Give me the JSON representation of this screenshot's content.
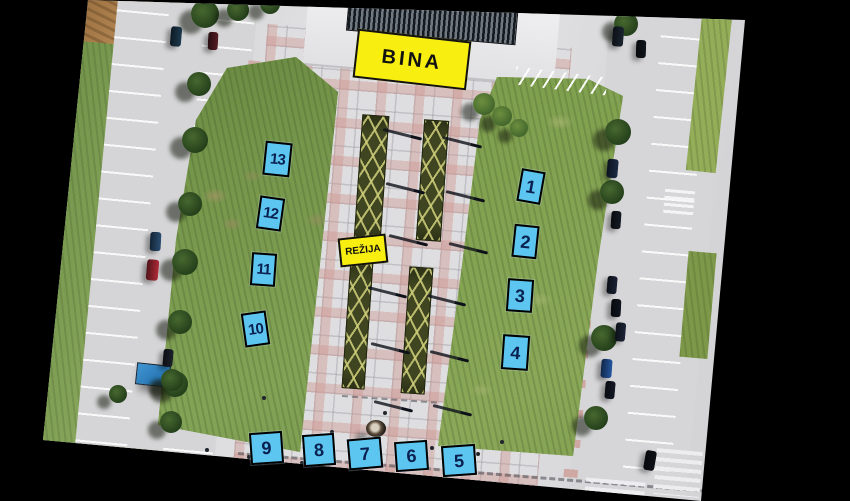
{
  "annotations": {
    "stage": {
      "label": "BINA",
      "x": 410,
      "y": 57,
      "w": 110,
      "h": 45,
      "rot": 6.5
    },
    "control": {
      "label": "REŽIJA",
      "x": 361,
      "y": 248,
      "w": 44,
      "h": 25,
      "rot": -6
    }
  },
  "markers": [
    {
      "label": "13",
      "x": 275,
      "y": 157,
      "w": 23,
      "h": 30,
      "rot": 6
    },
    {
      "label": "12",
      "x": 268,
      "y": 211,
      "w": 21,
      "h": 29,
      "rot": 8
    },
    {
      "label": "11",
      "x": 261,
      "y": 267,
      "w": 21,
      "h": 29,
      "rot": 4
    },
    {
      "label": "10",
      "x": 253,
      "y": 327,
      "w": 21,
      "h": 30,
      "rot": -8
    },
    {
      "label": "1",
      "x": 529,
      "y": 184,
      "w": 20,
      "h": 29,
      "rot": 10
    },
    {
      "label": "2",
      "x": 523,
      "y": 239,
      "w": 21,
      "h": 29,
      "rot": 6
    },
    {
      "label": "3",
      "x": 518,
      "y": 293,
      "w": 22,
      "h": 29,
      "rot": 4
    },
    {
      "label": "4",
      "x": 513,
      "y": 350,
      "w": 23,
      "h": 31,
      "rot": 4
    },
    {
      "label": "9",
      "x": 264,
      "y": 446,
      "w": 29,
      "h": 28,
      "rot": -4
    },
    {
      "label": "8",
      "x": 317,
      "y": 448,
      "w": 28,
      "h": 28,
      "rot": -4
    },
    {
      "label": "7",
      "x": 363,
      "y": 451,
      "w": 30,
      "h": 27,
      "rot": -5
    },
    {
      "label": "6",
      "x": 409,
      "y": 454,
      "w": 29,
      "h": 26,
      "rot": -4
    },
    {
      "label": "5",
      "x": 457,
      "y": 458,
      "w": 30,
      "h": 27,
      "rot": -4
    }
  ],
  "colors": {
    "background": "#000000",
    "marker_fill": "#5cc6f0",
    "marker_border": "#000000",
    "marker_text": "#0a2050",
    "label_fill": "#f8ee10",
    "label_border": "#111111",
    "label_text": "#111111"
  }
}
